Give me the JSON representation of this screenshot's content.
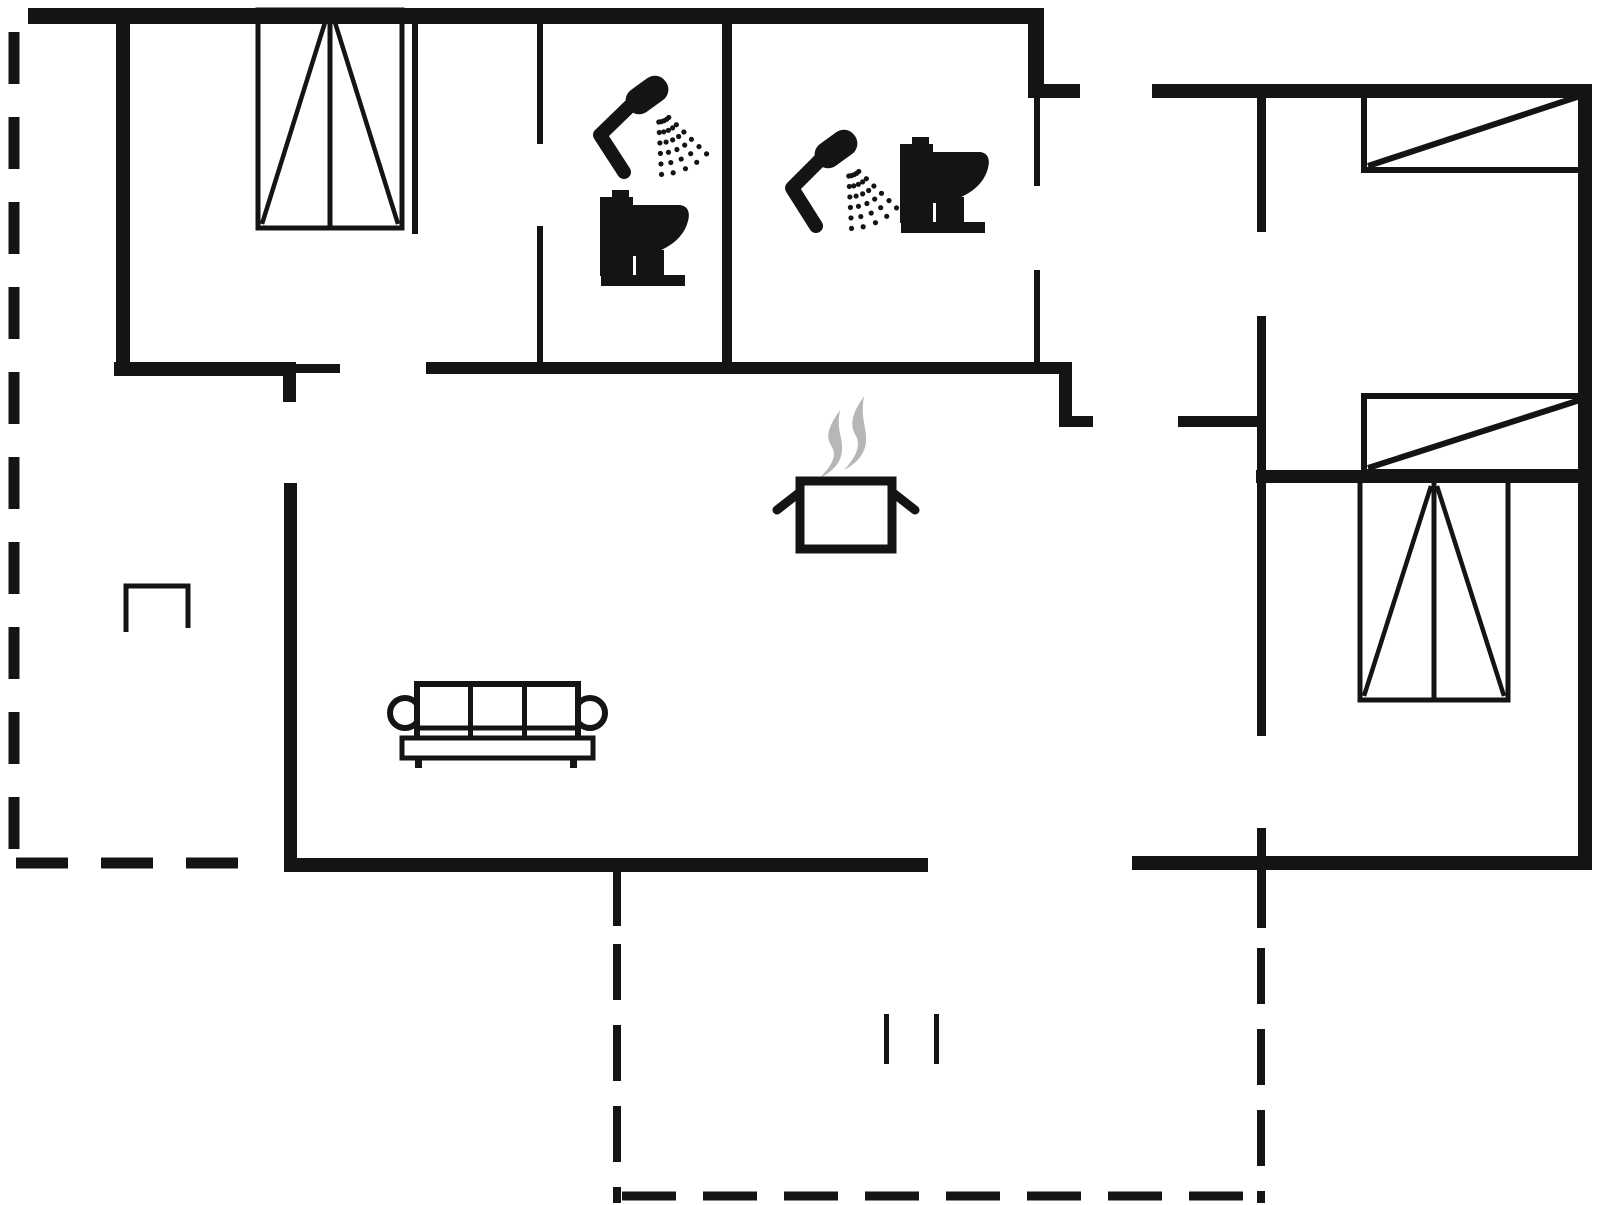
{
  "canvas": {
    "width": 1606,
    "height": 1205,
    "background": "#ffffff",
    "ink": "#141414",
    "steam_color": "#b7b7b7"
  },
  "walls": {
    "thick": [
      {
        "name": "top-exterior-wall",
        "x": 28,
        "y": 8,
        "w": 1016,
        "h": 16
      },
      {
        "name": "entry-right-wall",
        "x": 1028,
        "y": 8,
        "w": 16,
        "h": 90
      },
      {
        "name": "entry-door-jamb",
        "x": 1028,
        "y": 84,
        "w": 52,
        "h": 14
      },
      {
        "name": "right-wing-top-wall",
        "x": 1152,
        "y": 84,
        "w": 440,
        "h": 14
      },
      {
        "name": "right-exterior-wall",
        "x": 1578,
        "y": 84,
        "w": 14,
        "h": 786
      },
      {
        "name": "right-wing-bottom-wall",
        "x": 1132,
        "y": 856,
        "w": 460,
        "h": 14
      },
      {
        "name": "living-bottom-wall",
        "x": 284,
        "y": 858,
        "w": 644,
        "h": 14
      },
      {
        "name": "living-left-wall",
        "x": 284,
        "y": 483,
        "w": 13,
        "h": 389
      },
      {
        "name": "living-left-stub-wall",
        "x": 283,
        "y": 366,
        "w": 13,
        "h": 36
      },
      {
        "name": "bedroom1-bottom-wall",
        "x": 114,
        "y": 362,
        "w": 182,
        "h": 14
      },
      {
        "name": "left-exterior-wall",
        "x": 116,
        "y": 8,
        "w": 14,
        "h": 368
      },
      {
        "name": "corridor-bottom-wall",
        "x": 426,
        "y": 362,
        "w": 646,
        "h": 12
      },
      {
        "name": "step-wall-vertical",
        "x": 1059,
        "y": 362,
        "w": 13,
        "h": 64
      },
      {
        "name": "step-wall-jamb",
        "x": 1059,
        "y": 416,
        "w": 34,
        "h": 11
      },
      {
        "name": "hall-door-jamb",
        "x": 1178,
        "y": 416,
        "w": 86,
        "h": 11
      },
      {
        "name": "right-wing-divider-wall",
        "x": 1256,
        "y": 470,
        "w": 336,
        "h": 13
      }
    ],
    "medium": [
      {
        "name": "bathroom-divider-wall",
        "x": 722,
        "y": 8,
        "w": 10,
        "h": 356
      },
      {
        "name": "bedroom1-jamb-tick",
        "x": 296,
        "y": 364,
        "w": 44,
        "h": 9
      },
      {
        "name": "hall-wall-upper",
        "x": 1257,
        "y": 92,
        "w": 9,
        "h": 140
      },
      {
        "name": "hall-wall-middle",
        "x": 1257,
        "y": 316,
        "w": 9,
        "h": 420
      },
      {
        "name": "hall-wall-lower",
        "x": 1257,
        "y": 828,
        "w": 9,
        "h": 100
      }
    ],
    "thin": [
      {
        "name": "bedroom1-right-wall",
        "x": 412,
        "y": 8,
        "w": 6,
        "h": 226
      },
      {
        "name": "bathroom1-left-wall-upper",
        "x": 537,
        "y": 8,
        "w": 6,
        "h": 136
      },
      {
        "name": "bathroom1-left-wall-lower",
        "x": 537,
        "y": 226,
        "w": 6,
        "h": 138
      },
      {
        "name": "bathroom2-right-wall-upper",
        "x": 1034,
        "y": 96,
        "w": 6,
        "h": 90
      },
      {
        "name": "bathroom2-right-wall-lower",
        "x": 1034,
        "y": 270,
        "w": 6,
        "h": 94
      },
      {
        "name": "terrace-stub-wall",
        "x": 613,
        "y": 866,
        "w": 8,
        "h": 60
      }
    ]
  },
  "terrace_dashed_lines": [
    {
      "name": "terrace-left-vertical",
      "x1": 14,
      "y1": 32,
      "x2": 14,
      "y2": 852,
      "w": 11,
      "dash": 52,
      "gap": 33
    },
    {
      "name": "terrace-left-bottom",
      "x1": 16,
      "y1": 863,
      "x2": 270,
      "y2": 863,
      "w": 11,
      "dash": 52,
      "gap": 33
    },
    {
      "name": "terrace-mid-vertical",
      "x1": 617,
      "y1": 944,
      "x2": 617,
      "y2": 1203,
      "w": 8,
      "dash": 56,
      "gap": 25
    },
    {
      "name": "terrace-bottom-horizontal",
      "x1": 622,
      "y1": 1196,
      "x2": 1264,
      "y2": 1196,
      "w": 9,
      "dash": 54,
      "gap": 27
    },
    {
      "name": "terrace-right-vertical",
      "x1": 1261,
      "y1": 948,
      "x2": 1261,
      "y2": 1203,
      "w": 8,
      "dash": 56,
      "gap": 25
    }
  ],
  "beds": [
    {
      "name": "bed-top-right",
      "x": 1364,
      "y": 92,
      "w": 220,
      "h": 78
    },
    {
      "name": "bed-mid-right",
      "x": 1364,
      "y": 396,
      "w": 220,
      "h": 76
    }
  ],
  "wardrobes": [
    {
      "name": "wardrobe-bedroom1",
      "x": 258,
      "y": 10,
      "w": 144,
      "h": 218
    },
    {
      "name": "wardrobe-bedroom3",
      "x": 1360,
      "y": 480,
      "w": 148,
      "h": 220
    }
  ],
  "table": {
    "name": "side-table",
    "x": 126,
    "y": 586,
    "w": 62,
    "h": 46
  },
  "door_marks": [
    {
      "x": 884,
      "y": 1014,
      "w": 5,
      "h": 50
    },
    {
      "x": 934,
      "y": 1014,
      "w": 5,
      "h": 50
    }
  ],
  "sofa": {
    "back": {
      "x": 417,
      "y": 684,
      "w": 161,
      "h": 56
    },
    "cushion_dividers_x": [
      470.5,
      524.5
    ],
    "cushion_bottom_y": 728,
    "seat": {
      "x": 402,
      "y": 738,
      "w": 191,
      "h": 20
    },
    "armrests": [
      {
        "cx": 405,
        "cy": 713,
        "r": 15
      },
      {
        "cx": 590,
        "cy": 713,
        "r": 15
      }
    ],
    "legs": [
      {
        "x": 415,
        "y": 758,
        "w": 7,
        "h": 10
      },
      {
        "x": 570,
        "y": 758,
        "w": 7,
        "h": 10
      }
    ]
  },
  "pot": {
    "body": {
      "x": 800,
      "y": 481,
      "w": 92,
      "h": 68
    },
    "handles": [
      [
        777,
        510,
        800,
        492
      ],
      [
        892,
        492,
        915,
        510
      ]
    ],
    "steam_paths": [
      "M840,410 C830,425 824,435 832,447 C837,456 832,465 820,478 C834,471 842,461 842,449 C843,438 836,430 840,410 Z",
      "M864,396 C854,411 848,423 856,436 C861,446 856,457 844,470 C858,463 866,452 866,440 C867,428 860,418 864,396 Z"
    ]
  },
  "showers": [
    {
      "name": "shower-bathroom1",
      "arm": [
        [
          633,
          103
        ],
        [
          600,
          135
        ],
        [
          624,
          172
        ]
      ],
      "head": {
        "cx": 647,
        "cy": 95,
        "angle": -36
      },
      "spray": {
        "ox": 658,
        "oy": 107
      }
    },
    {
      "name": "shower-bathroom2",
      "arm": [
        [
          823,
          157
        ],
        [
          792,
          188
        ],
        [
          816,
          226
        ]
      ],
      "head": {
        "cx": 836,
        "cy": 149,
        "angle": -36
      },
      "spray": {
        "ox": 848,
        "oy": 161
      }
    }
  ],
  "toilets": [
    {
      "name": "toilet-bathroom1",
      "x": 600,
      "y": 190
    },
    {
      "name": "toilet-bathroom2",
      "x": 900,
      "y": 137
    }
  ],
  "toilet_shape": {
    "button": [
      12,
      0,
      17,
      9
    ],
    "tank": [
      0,
      7,
      33,
      79
    ],
    "bowl_path": "M33,15 L80,15 C89,16 90,24 88,31 C83,52 60,63 42,66 L33,66 Z",
    "pedestal": [
      36,
      60,
      28,
      28
    ],
    "base": [
      1,
      85,
      84,
      11
    ]
  },
  "spray_params": {
    "angles_deg": [
      44,
      55,
      66,
      77,
      87
    ],
    "dots_per_ray": 6,
    "start_radius": 15,
    "step": 10.5,
    "dot_radius": 2.6
  }
}
